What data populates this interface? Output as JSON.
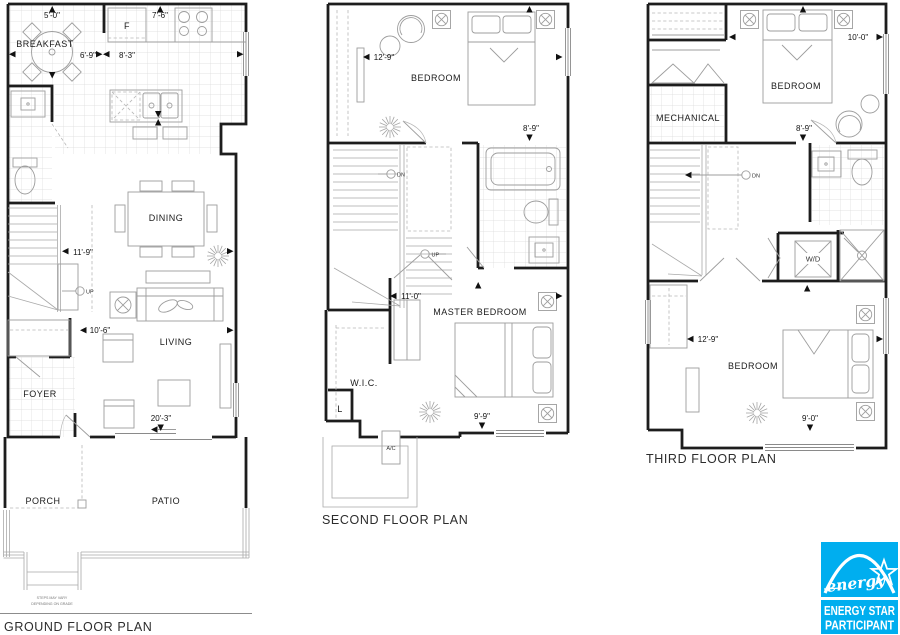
{
  "plans": {
    "ground": {
      "title": "GROUND FLOOR PLAN",
      "rooms": {
        "breakfast": "BREAKFAST",
        "dining": "DINING",
        "living": "LIVING",
        "foyer": "FOYER",
        "porch": "PORCH",
        "patio": "PATIO"
      },
      "labels": {
        "fridge": "F",
        "up": "UP"
      },
      "dims": {
        "w_breakfast": "5'-0\"",
        "w_kitchen": "7'-6\"",
        "d_breakfast": "6'-9\"",
        "d_kitchen": "8'-3\"",
        "w_dining": "11'-9\"",
        "w_living": "10'-6\"",
        "w_patio": "20'-3\""
      },
      "note_line1": "STEPS MAY VARY",
      "note_line2": "DEPENDING ON GRADE"
    },
    "second": {
      "title": "SECOND FLOOR PLAN",
      "rooms": {
        "bedroom": "BEDROOM",
        "master": "MASTER BEDROOM",
        "wic": "W.I.C."
      },
      "labels": {
        "dn": "DN",
        "up": "UP",
        "linen": "L",
        "ac": "A/C"
      },
      "dims": {
        "w_bedroom": "12'-9\"",
        "d_bedroom": "8'-9\"",
        "w_master": "11'-0\"",
        "d_master": "9'-9\""
      }
    },
    "third": {
      "title": "THIRD FLOOR PLAN",
      "rooms": {
        "bedroom_top": "BEDROOM",
        "mechanical": "MECHANICAL",
        "bedroom_bottom": "BEDROOM"
      },
      "labels": {
        "dn": "DN",
        "wd": "W/D"
      },
      "dims": {
        "w_bedroom_top": "10'-0\"",
        "d_bedroom_top": "8'-9\"",
        "w_bedroom_bottom": "12'-9\"",
        "d_bedroom_bottom": "9'-0\""
      }
    }
  },
  "logo": {
    "script": "energy",
    "line1": "ENERGY STAR",
    "line2": "PARTICIPANT",
    "blue": "#00AEEF"
  }
}
